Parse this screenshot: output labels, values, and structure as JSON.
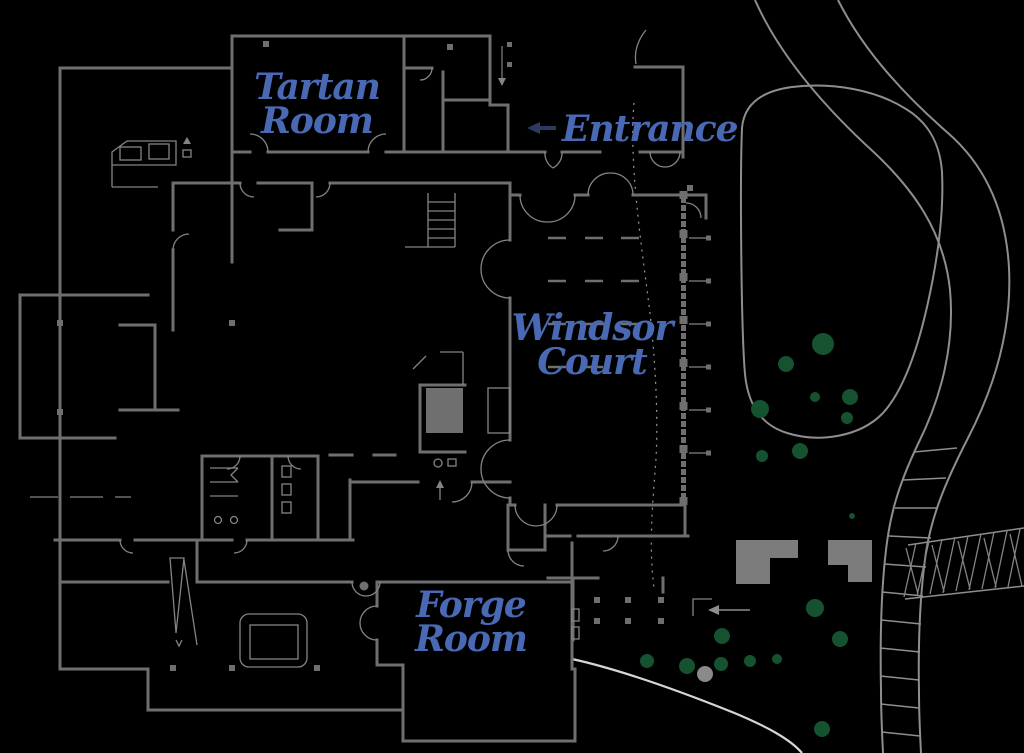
{
  "labels": {
    "tartan": {
      "line1": "Tartan",
      "line2": "Room"
    },
    "windsor": {
      "line1": "Windsor",
      "line2": "Court"
    },
    "forge": {
      "line1": "Forge",
      "line2": "Room"
    },
    "entrance": {
      "text": "Entrance",
      "arrow": "←",
      "direction": "left"
    }
  },
  "rooms": [
    "Tartan Room",
    "Windsor Court",
    "Forge Room"
  ],
  "colors": {
    "bg": "#000000",
    "wall": "#6f6f6f",
    "wallThin": "#848484",
    "road": "#8e8e8e",
    "labelBlue": "#4a69b4",
    "arrowNavy": "#2b3a5e",
    "treeGreen": "#15522f",
    "treeGray": "#8a8a8a",
    "pathWhite": "#d6d6d6",
    "blobGray": "#7c7c7c"
  },
  "site": {
    "tree_count": 19,
    "trees": [
      {
        "x": 823,
        "y": 344,
        "r": 11
      },
      {
        "x": 786,
        "y": 364,
        "r": 8
      },
      {
        "x": 815,
        "y": 397,
        "r": 5
      },
      {
        "x": 850,
        "y": 397,
        "r": 8
      },
      {
        "x": 847,
        "y": 418,
        "r": 6
      },
      {
        "x": 760,
        "y": 409,
        "r": 9
      },
      {
        "x": 800,
        "y": 451,
        "r": 8
      },
      {
        "x": 762,
        "y": 456,
        "r": 6
      },
      {
        "x": 852,
        "y": 516,
        "r": 3
      },
      {
        "x": 815,
        "y": 608,
        "r": 9
      },
      {
        "x": 840,
        "y": 639,
        "r": 8
      },
      {
        "x": 722,
        "y": 636,
        "r": 8
      },
      {
        "x": 687,
        "y": 666,
        "r": 8
      },
      {
        "x": 721,
        "y": 664,
        "r": 7
      },
      {
        "x": 750,
        "y": 661,
        "r": 6
      },
      {
        "x": 777,
        "y": 659,
        "r": 5
      },
      {
        "x": 822,
        "y": 729,
        "r": 8
      },
      {
        "x": 647,
        "y": 661,
        "r": 7
      },
      {
        "x": 705,
        "y": 674,
        "r": 8,
        "color": "gray"
      }
    ]
  }
}
